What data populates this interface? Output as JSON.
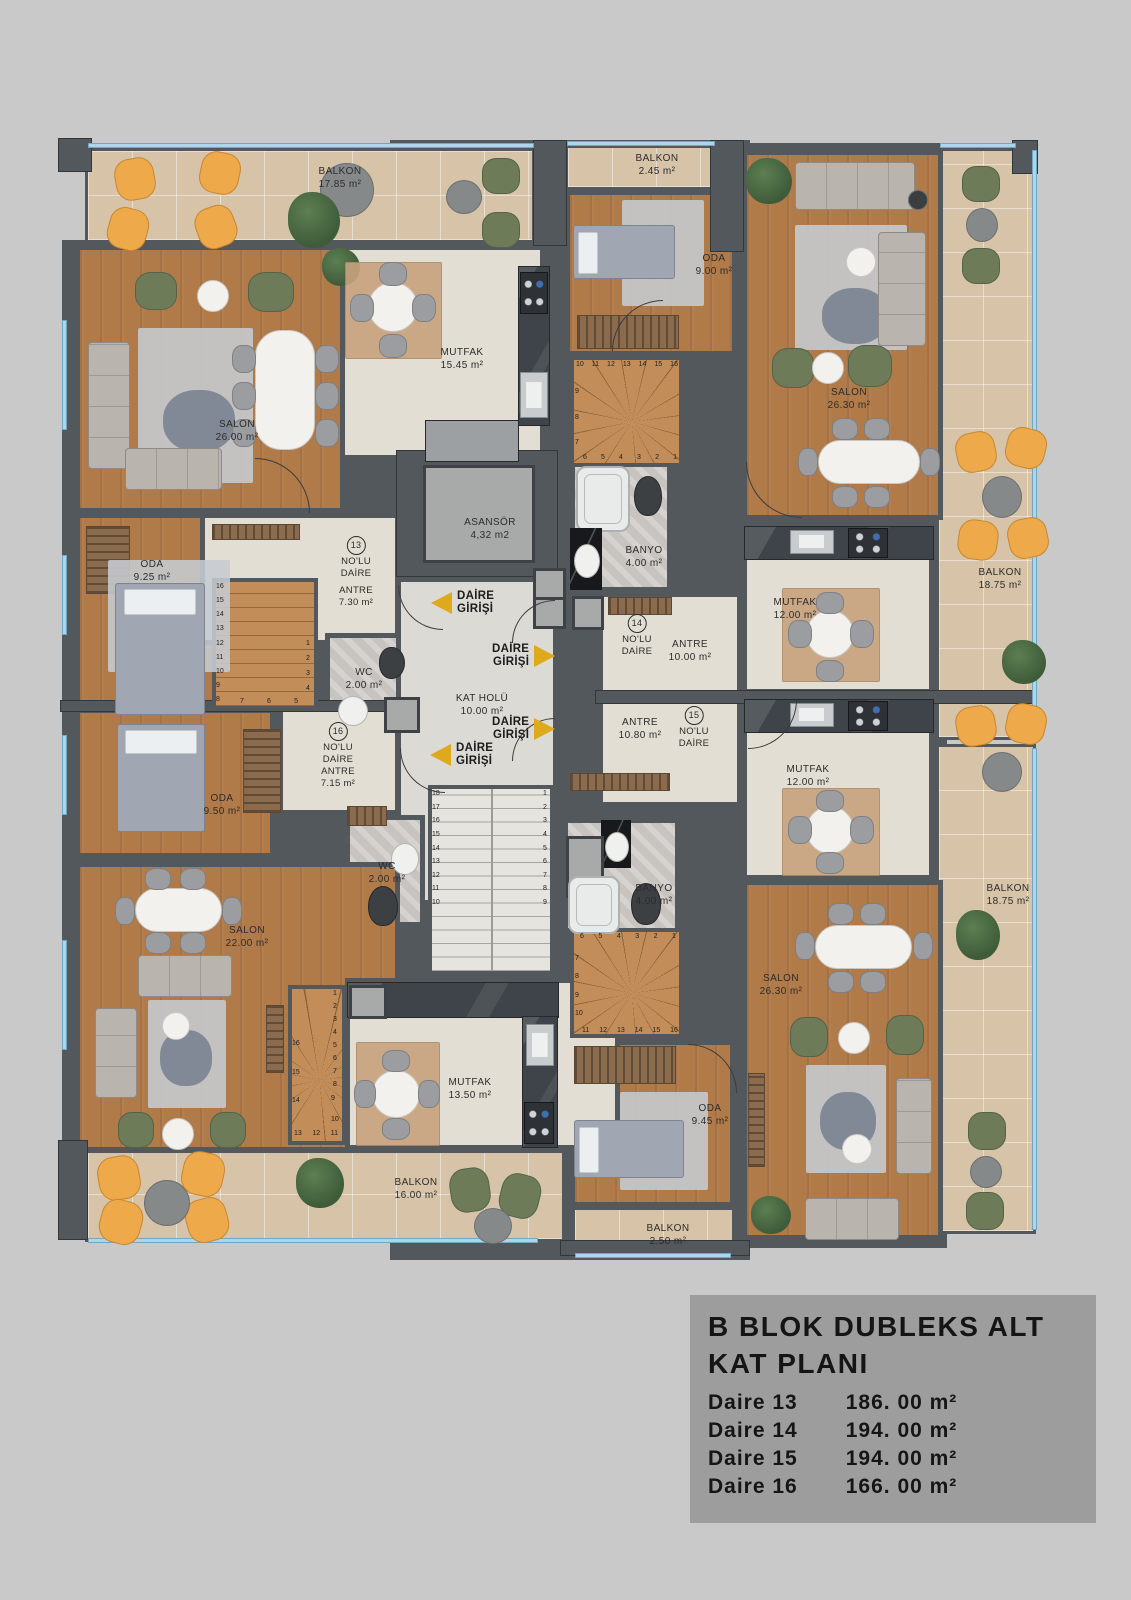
{
  "colors": {
    "page": "#c9c9c9",
    "wall": "#53585c",
    "wood": "#b07a49",
    "wood-light": "#c28d58",
    "cream": "#e2ded3",
    "beige": "#d6c3a8",
    "marble": "#dcdad5",
    "bath": "#c7c3bf",
    "black-marble": "#17191c",
    "arrow": "#dfa91c",
    "legend-bg": "#9d9d9d",
    "window": "#aed6e8",
    "text": "#2c2c2c"
  },
  "legend": {
    "title_line1": "B BLOK DUBLEKS ALT",
    "title_line2": "KAT PLANI",
    "rows": [
      {
        "label": "Daire 13",
        "area": "186. 00 m²"
      },
      {
        "label": "Daire 14",
        "area": "194. 00 m²"
      },
      {
        "label": "Daire 15",
        "area": "194. 00 m²"
      },
      {
        "label": "Daire 16",
        "area": "166. 00 m²"
      }
    ]
  },
  "core": {
    "elevator": {
      "name": "ASANSÖR",
      "area": "4,32 m2"
    },
    "hall": {
      "name": "KAT HOLÜ",
      "area": "10.00 m²"
    }
  },
  "entry": {
    "line1": "DAİRE",
    "line2": "GİRİŞİ"
  },
  "unit_suffix": {
    "line1": "NO'LU",
    "line2": "DAİRE"
  },
  "units": {
    "u13": "13",
    "u14": "14",
    "u15": "15",
    "u16": "16"
  },
  "rooms": {
    "balkon13": {
      "name": "BALKON",
      "area": "17.85 m²"
    },
    "salon13": {
      "name": "SALON",
      "area": "26.00 m²"
    },
    "mutfak13": {
      "name": "MUTFAK",
      "area": "15.45 m²"
    },
    "oda13": {
      "name": "ODA",
      "area": "9.25 m²"
    },
    "antre13": {
      "name": "ANTRE",
      "area": "7.30 m²"
    },
    "wc13": {
      "name": "WC",
      "area": "2.00 m²"
    },
    "balkon14_top": {
      "name": "BALKON",
      "area": "2.45 m²"
    },
    "oda14": {
      "name": "ODA",
      "area": "9.00 m²"
    },
    "salon14": {
      "name": "SALON",
      "area": "26.30 m²"
    },
    "banyo14": {
      "name": "BANYO",
      "area": "4.00 m²"
    },
    "antre14": {
      "name": "ANTRE",
      "area": "10.00 m²"
    },
    "mutfak14": {
      "name": "MUTFAK",
      "area": "12.00 m²"
    },
    "balkon14_right": {
      "name": "BALKON",
      "area": "18.75 m²"
    },
    "antre15": {
      "name": "ANTRE",
      "area": "10.80 m²"
    },
    "mutfak15": {
      "name": "MUTFAK",
      "area": "12.00 m²"
    },
    "banyo15": {
      "name": "BANYO",
      "area": "4.00 m²"
    },
    "salon15": {
      "name": "SALON",
      "area": "26.30 m²"
    },
    "oda15": {
      "name": "ODA",
      "area": "9.45 m²"
    },
    "balkon15_bottom": {
      "name": "BALKON",
      "area": "2.50 m²"
    },
    "balkon15_right": {
      "name": "BALKON",
      "area": "18.75 m²"
    },
    "oda16": {
      "name": "ODA",
      "area": "9.50 m²"
    },
    "antre16": {
      "name": "ANTRE",
      "area": "7.15 m²"
    },
    "wc16": {
      "name": "WC",
      "area": "2.00 m²"
    },
    "salon16": {
      "name": "SALON",
      "area": "22.00 m²"
    },
    "mutfak16": {
      "name": "MUTFAK",
      "area": "13.50 m²"
    },
    "balkon16": {
      "name": "BALKON",
      "area": "16.00 m²"
    }
  },
  "stairs": {
    "main_left": [
      "18",
      "17",
      "16",
      "15",
      "14",
      "13",
      "12",
      "11",
      "10"
    ],
    "main_right": [
      "1",
      "2",
      "3",
      "4",
      "5",
      "6",
      "7",
      "8",
      "9"
    ],
    "s13_left": [
      "16",
      "15",
      "14",
      "13",
      "12",
      "11",
      "10",
      "9",
      "8"
    ],
    "s13_right": [
      "1",
      "2",
      "3",
      "4"
    ],
    "s13_bottom": [
      "7",
      "6",
      "5"
    ],
    "s14_top": [
      "10",
      "11",
      "12",
      "13",
      "14",
      "15",
      "16"
    ],
    "s14_left": [
      "9",
      "8",
      "7"
    ],
    "s14_bottom": [
      "6",
      "5",
      "4",
      "3",
      "2",
      "1"
    ],
    "s15_top": [
      "6",
      "5",
      "4",
      "3",
      "2",
      "1"
    ],
    "s15_left": [
      "7",
      "8",
      "9",
      "10"
    ],
    "s15_bottom": [
      "11",
      "12",
      "13",
      "14",
      "15",
      "16"
    ],
    "s16_left": [
      "16",
      "15",
      "14"
    ],
    "s16_right": [
      "1",
      "2",
      "3",
      "4",
      "5",
      "6",
      "7",
      "8"
    ],
    "s16_lower": [
      "9",
      "10"
    ],
    "s16_bottom": [
      "13",
      "12",
      "11"
    ]
  }
}
